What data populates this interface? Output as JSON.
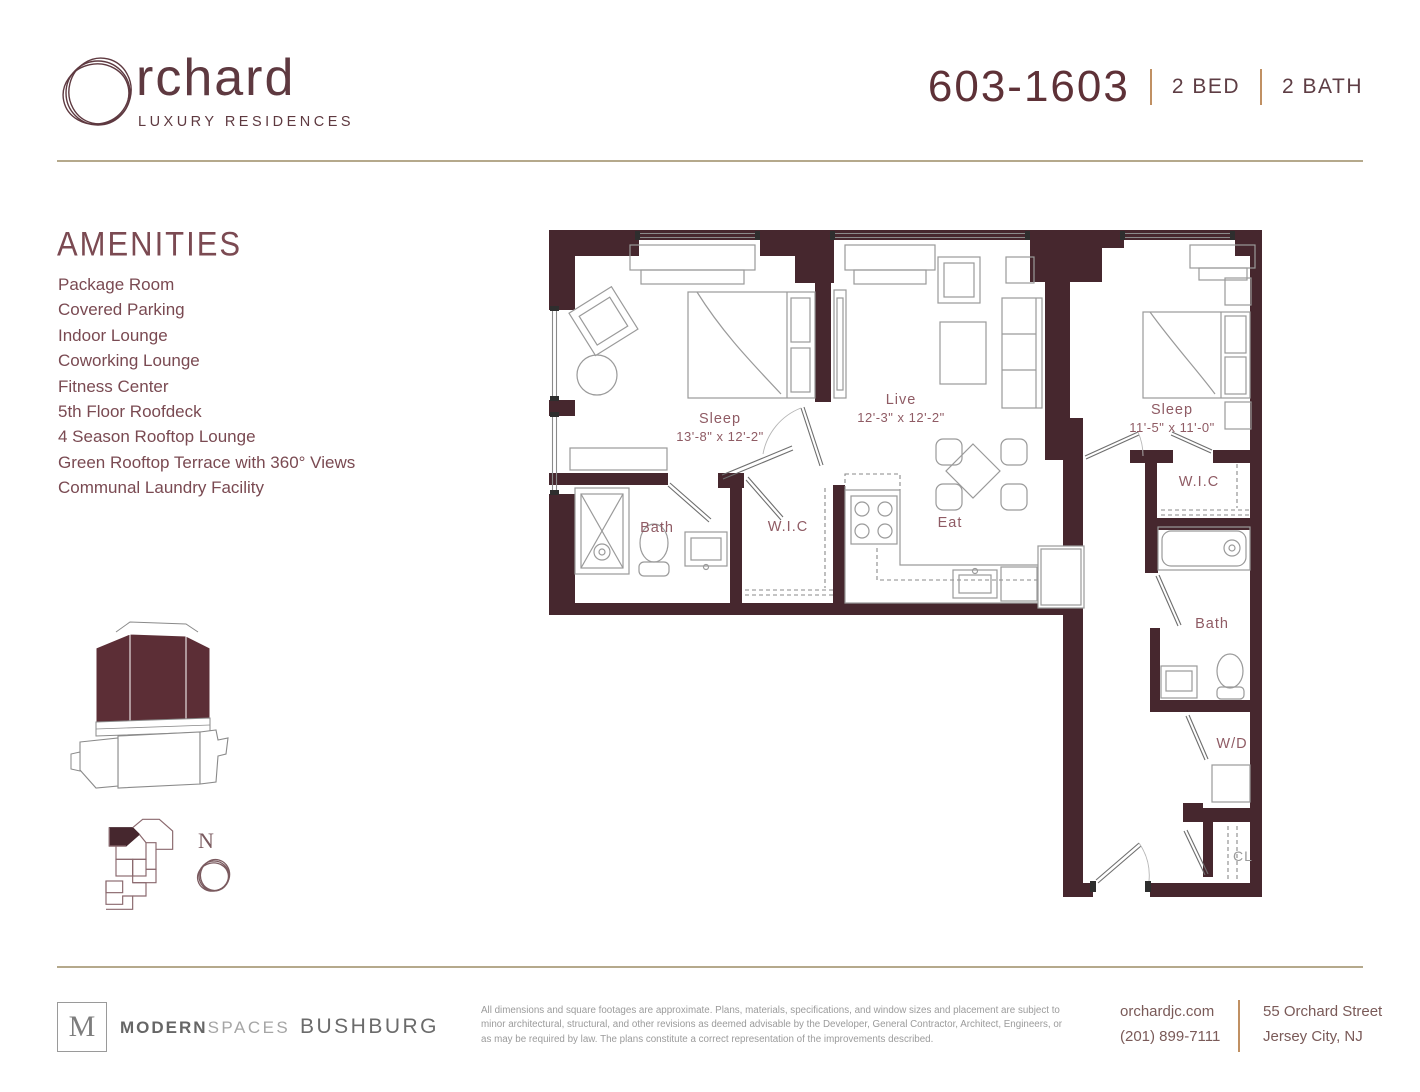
{
  "brand": {
    "wordmark": "rchard",
    "tagline": "LUXURY RESIDENCES"
  },
  "unit": {
    "number": "603-1603",
    "beds": "2 BED",
    "baths": "2 BATH"
  },
  "amenities": {
    "heading": "AMENITIES",
    "items": [
      "Package Room",
      "Covered Parking",
      "Indoor Lounge",
      "Coworking Lounge",
      "Fitness Center",
      "5th Floor Roofdeck",
      "4 Season Rooftop Lounge",
      "Green Rooftop Terrace with 360° Views",
      "Communal Laundry Facility"
    ]
  },
  "floorplan": {
    "north_label": "N",
    "rooms": [
      {
        "name": "Sleep",
        "dims": "13'-8\" x 12'-2\""
      },
      {
        "name": "Live",
        "dims": "12'-3\" x 12'-2\""
      },
      {
        "name": "Sleep",
        "dims": "11'-5\" x 11'-0\""
      },
      {
        "name": "Bath",
        "dims": ""
      },
      {
        "name": "W.I.C",
        "dims": ""
      },
      {
        "name": "Eat",
        "dims": ""
      },
      {
        "name": "W.I.C",
        "dims": ""
      },
      {
        "name": "Bath",
        "dims": ""
      },
      {
        "name": "W/D",
        "dims": ""
      },
      {
        "name": "CL",
        "dims": ""
      }
    ]
  },
  "footer": {
    "broker_initial": "M",
    "broker_name_bold": "MODERN",
    "broker_name_light": "SPACES",
    "developer": "BUSHBURG",
    "disclaimer": "All dimensions and square footages are approximate. Plans, materials, specifications, and window sizes and placement are subject to minor architectural, structural, and other revisions as deemed advisable by the Developer, General Contractor, Architect, Engineers, or as may be required by law. The plans constitute a correct representation of the improvements described.",
    "website": "orchardjc.com",
    "phone": "(201) 899-7111",
    "address_line1": "55 Orchard Street",
    "address_line2": "Jersey City, NJ"
  },
  "colors": {
    "wall": "#46272e",
    "brand_maroon": "#5e3940",
    "label_maroon": "#8f5b64",
    "tan_rule": "#b5a98c",
    "tan_separator": "#c09063"
  }
}
